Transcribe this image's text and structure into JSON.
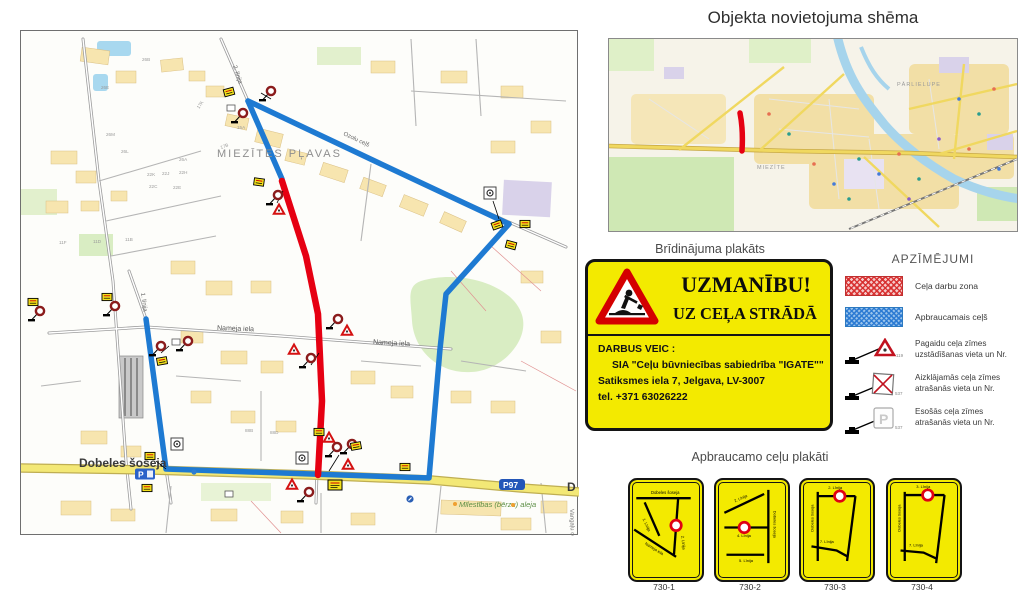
{
  "colors": {
    "work_zone": "#e60012",
    "detour": "#1e7ad2",
    "poster_yellow": "#f3ea00",
    "road_yellow": "#f3e876"
  },
  "overview": {
    "title": "Objekta novietojuma shēma",
    "district_parlielupe": "PĀRLIELUPE",
    "district_miezite": "MIEZĪTE"
  },
  "main_map": {
    "area_label": "MIEZĪTES PĻAVAS",
    "streets": {
      "linija2": "2. līnija",
      "ozolu": "Ozolu ceļš",
      "nameja1": "Nameja iela",
      "nameja2": "Nameja iela",
      "linija1": "1. līnija",
      "dobeles": "Dobeles šoseja",
      "dobeles_cont": "D",
      "milestibas": "Mīlestības (bērzu) aleja",
      "vangalu": "Vangaļu ceļš"
    },
    "road_badge": "P97",
    "parking_badge": "P",
    "parcels": [
      "26E",
      "26B",
      "26M",
      "26L",
      "26A",
      "22K",
      "22J",
      "22H",
      "22C",
      "22E",
      "17K",
      "17B",
      "15A",
      "11F",
      "11D",
      "11B",
      "88B",
      "88D"
    ]
  },
  "warning": {
    "title": "Brīdinājuma plakāts",
    "heading1": "UZMANĪBU!",
    "heading2": "UZ CEĻA STRĀDĀ",
    "body1": "DARBUS VEIC :",
    "body2": "SIA \"Ceļu būvniecības sabiedrība \"IGATE\"\"",
    "body3": "Satiksmes iela 7, Jelgava, LV-3007",
    "body4": "tel. +371 63026222"
  },
  "legend": {
    "title": "APZĪMĒJUMI",
    "items": [
      {
        "icon": "work-zone-swatch",
        "label": "Ceļa darbu zona"
      },
      {
        "icon": "detour-swatch",
        "label": "Apbraucamais ceļš"
      },
      {
        "icon": "temporary-sign-icon",
        "line1": "Pagaidu ceļa zīmes",
        "line2": "uzstādīšanas vieta un Nr.",
        "sign_no": "119"
      },
      {
        "icon": "covered-sign-icon",
        "line1": "Aizklājamās ceļa zīmes",
        "line2": "atrašanās vieta un Nr.",
        "sign_no": "537"
      },
      {
        "icon": "existing-sign-icon",
        "line1": "Esošās ceļa zīmes",
        "line2": "atrašanās vieta un Nr.",
        "sign_no": "537"
      }
    ]
  },
  "detour": {
    "title": "Apbraucamo ceļu plakāti",
    "posters": [
      {
        "id": "730-1",
        "top": "Dobeles šoseja",
        "left": "1. Līnija",
        "diag": "Nameja iela",
        "right": "2. Līnija"
      },
      {
        "id": "730-2",
        "right": "Dobeles šoseja",
        "mid": "4. Līnija",
        "top": "2. Līnija",
        "bottom": "5. Līnija"
      },
      {
        "id": "730-3",
        "left": "Dobeles šoseja",
        "top": "2. Līnija",
        "bottom": "7. Līnija"
      },
      {
        "id": "730-4",
        "left": "Dobeles šoseja",
        "top": "3. Līnija",
        "bottom": "7. Līnija"
      }
    ]
  }
}
